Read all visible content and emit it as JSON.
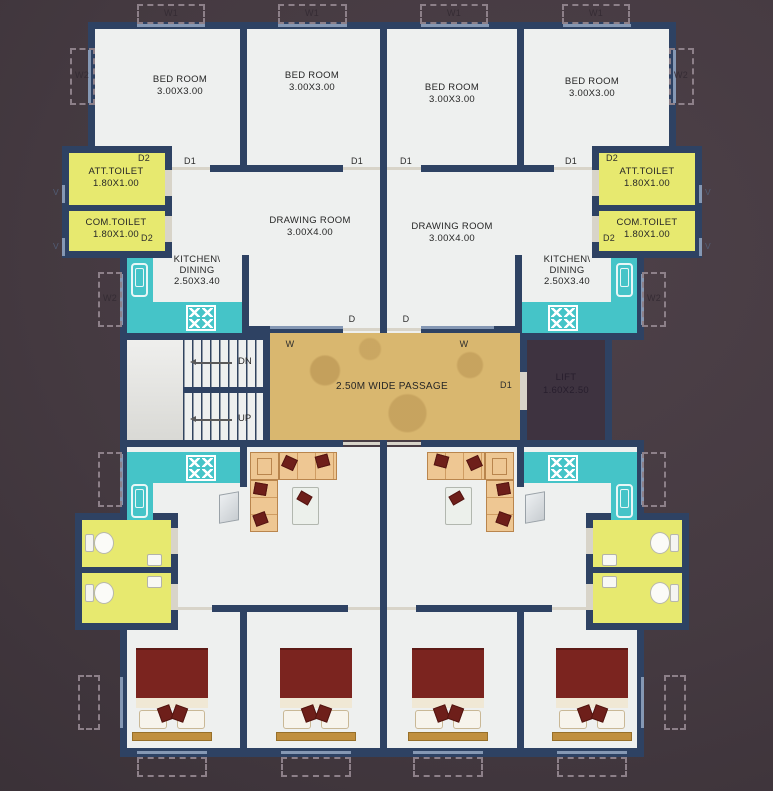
{
  "plan_title": "residential floor plan",
  "colors": {
    "background": "#453a41",
    "wall": "#2e4263",
    "floor": "#eef0ef",
    "toilet_room": "#e7e96f",
    "kitchen_counter": "#45c4c8",
    "passage": "#d9b76f",
    "sofa": "#eec793",
    "cushion": "#6e1f1a",
    "blanket": "#7b241f",
    "bed_base": "#c08f3e"
  },
  "rooms": {
    "bedroom": {
      "name": "BED ROOM",
      "dims": "3.00X3.00"
    },
    "drawing_room": {
      "name": "DRAWING ROOM",
      "dims": "3.00X4.00"
    },
    "kitchen": {
      "name_line1": "KITCHEN\\",
      "name_line2": "DINING",
      "dims": "2.50X3.40"
    },
    "att_toilet": {
      "name": "ATT.TOILET",
      "dims": "1.80X1.00"
    },
    "com_toilet": {
      "name": "COM.TOILET",
      "dims": "1.80X1.00"
    },
    "lift": {
      "name": "LIFT",
      "dims": "1.60X2.50"
    },
    "passage": {
      "name": "2.50M WIDE PASSAGE"
    }
  },
  "stairs": {
    "dn": "DN",
    "up": "UP"
  },
  "markers": {
    "d": "D",
    "d1": "D1",
    "d2": "D2",
    "w": "W",
    "w1": "W1",
    "w2": "W2",
    "v": "V"
  }
}
